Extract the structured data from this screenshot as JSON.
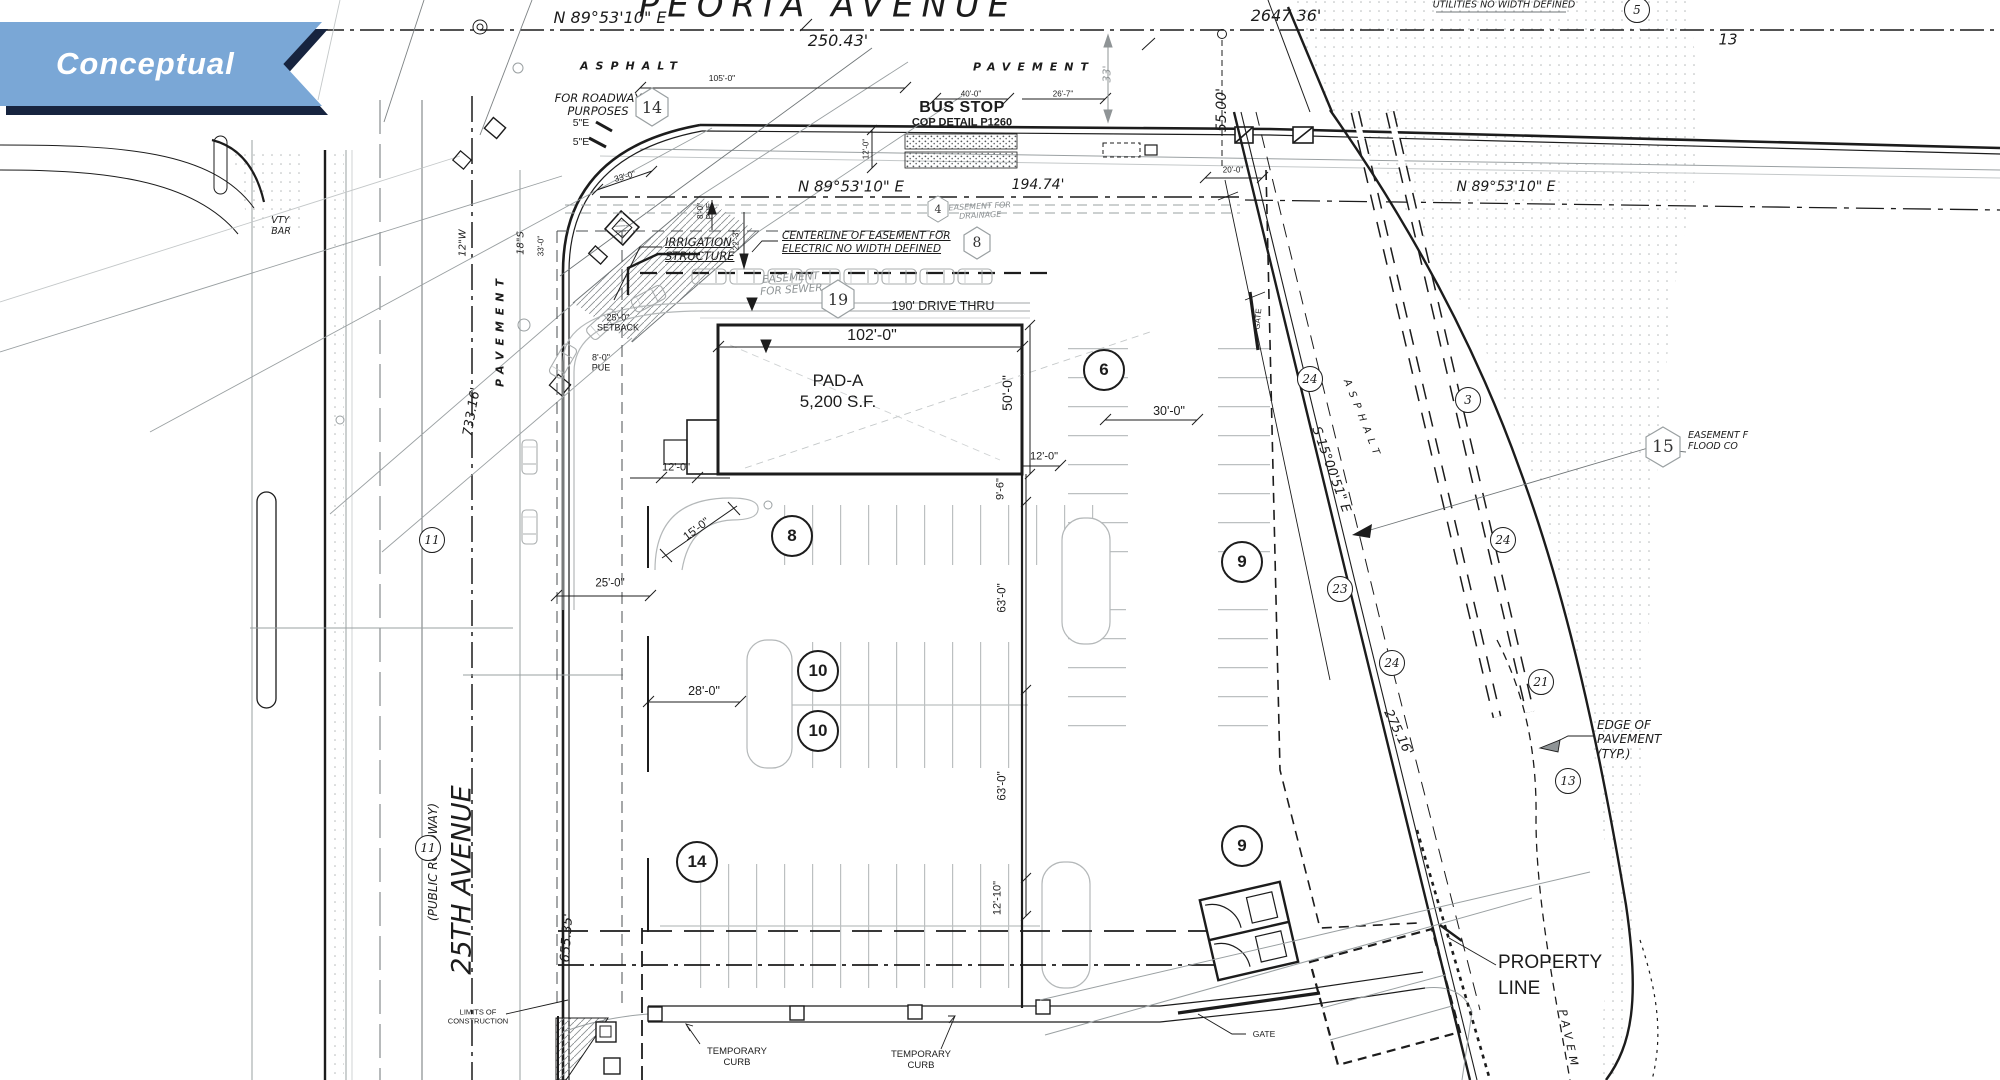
{
  "banner": {
    "label": "Conceptual",
    "bg_color": "#7aa7d6",
    "shadow_color": "#17243f"
  },
  "streets": {
    "peoria": "PEORIA AVENUE",
    "ave25": "25TH AVENUE",
    "public_roadway": "(PUBLIC ROADWAY)"
  },
  "bearings": {
    "b1": "N 89°53'10\" E",
    "b2": "N 89°53'10\" E",
    "b3": "N 89°53'10\" E",
    "s15": "S 15°00'51\" E"
  },
  "distances": {
    "d250": "250.43'",
    "d2647": "2647.36'",
    "d194": "194.74'",
    "d655": "655.35'",
    "d733": "733.16'",
    "d275": "275.16'",
    "d13": "13"
  },
  "dims": {
    "d105": "105'-0\"",
    "d40": "40'-0\"",
    "d26_7": "26'-7\"",
    "d20": "20'-0\"",
    "d33": "33'",
    "d55": "55.00'",
    "d12bus": "12'-0\"",
    "d33d": "33'-0\"",
    "d33v": "33'-0\"",
    "d12w": "12\"W",
    "d18s": "18\"S",
    "d22_3": "22'-3\"",
    "pue8": "8'-0\"\nPUE",
    "setback": "25'-0\"\nSETBACK",
    "d102": "102'-0\"",
    "d50": "50'-0\"",
    "d12bldg": "12'-0\"",
    "d15": "15'-0\"",
    "d12r": "12'-0\"",
    "d9_6": "9'-6\"",
    "d63a": "63'-0\"",
    "d63b": "63'-0\"",
    "d25": "25'-0\"",
    "d30": "30'-0\"",
    "d28": "28'-0\"",
    "d12_10": "12'-10\""
  },
  "labels": {
    "asphalt_top": "ASPHALT",
    "pavement_top": "PAVEMENT",
    "asphalt_right": "ASPHALT",
    "pavement_left": "PAVEMENT",
    "pavement_br": "PAVEM",
    "for_roadway": "FOR ROADWAY\nPURPOSES",
    "e5a": "5\"E",
    "e5b": "5\"E",
    "bus_stop": "BUS STOP",
    "cop_detail": "COP DETAIL P1260",
    "utilities": "UTILITIES NO WIDTH DEFINED",
    "irrigation": "IRRIGATION\nSTRUCTURE",
    "centerline_easement": "CENTERLINE OF EASEMENT FOR\nELECTRIC NO WIDTH DEFINED",
    "easement_sewer": "EASEMENT\nFOR SEWER",
    "easement_drainage": "EASEMENT FOR\nDRAINAGE",
    "drive_thru": "190' DRIVE THRU",
    "pad_a": "PAD-A\n5,200 S.F.",
    "gate_top": "GATE",
    "gate_bottom": "GATE",
    "property_line": "PROPERTY\nLINE",
    "temp_curb": "TEMPORARY\nCURB",
    "limits": "LIMITS OF\nCONSTRUCTION",
    "edge_pavement": "EDGE OF\nPAVEMENT\n(TYP.)",
    "easement_flood": "EASEMENT F\nFLOOD CO",
    "vty": "VTY\nBAR"
  },
  "keynotes": {
    "hex": [
      "14",
      "8",
      "19",
      "4",
      "15"
    ],
    "large": [
      "6",
      "8",
      "9",
      "10",
      "10",
      "14",
      "9"
    ],
    "small": [
      "11",
      "11",
      "24",
      "3",
      "23",
      "24",
      "24",
      "21",
      "13",
      "5"
    ]
  }
}
